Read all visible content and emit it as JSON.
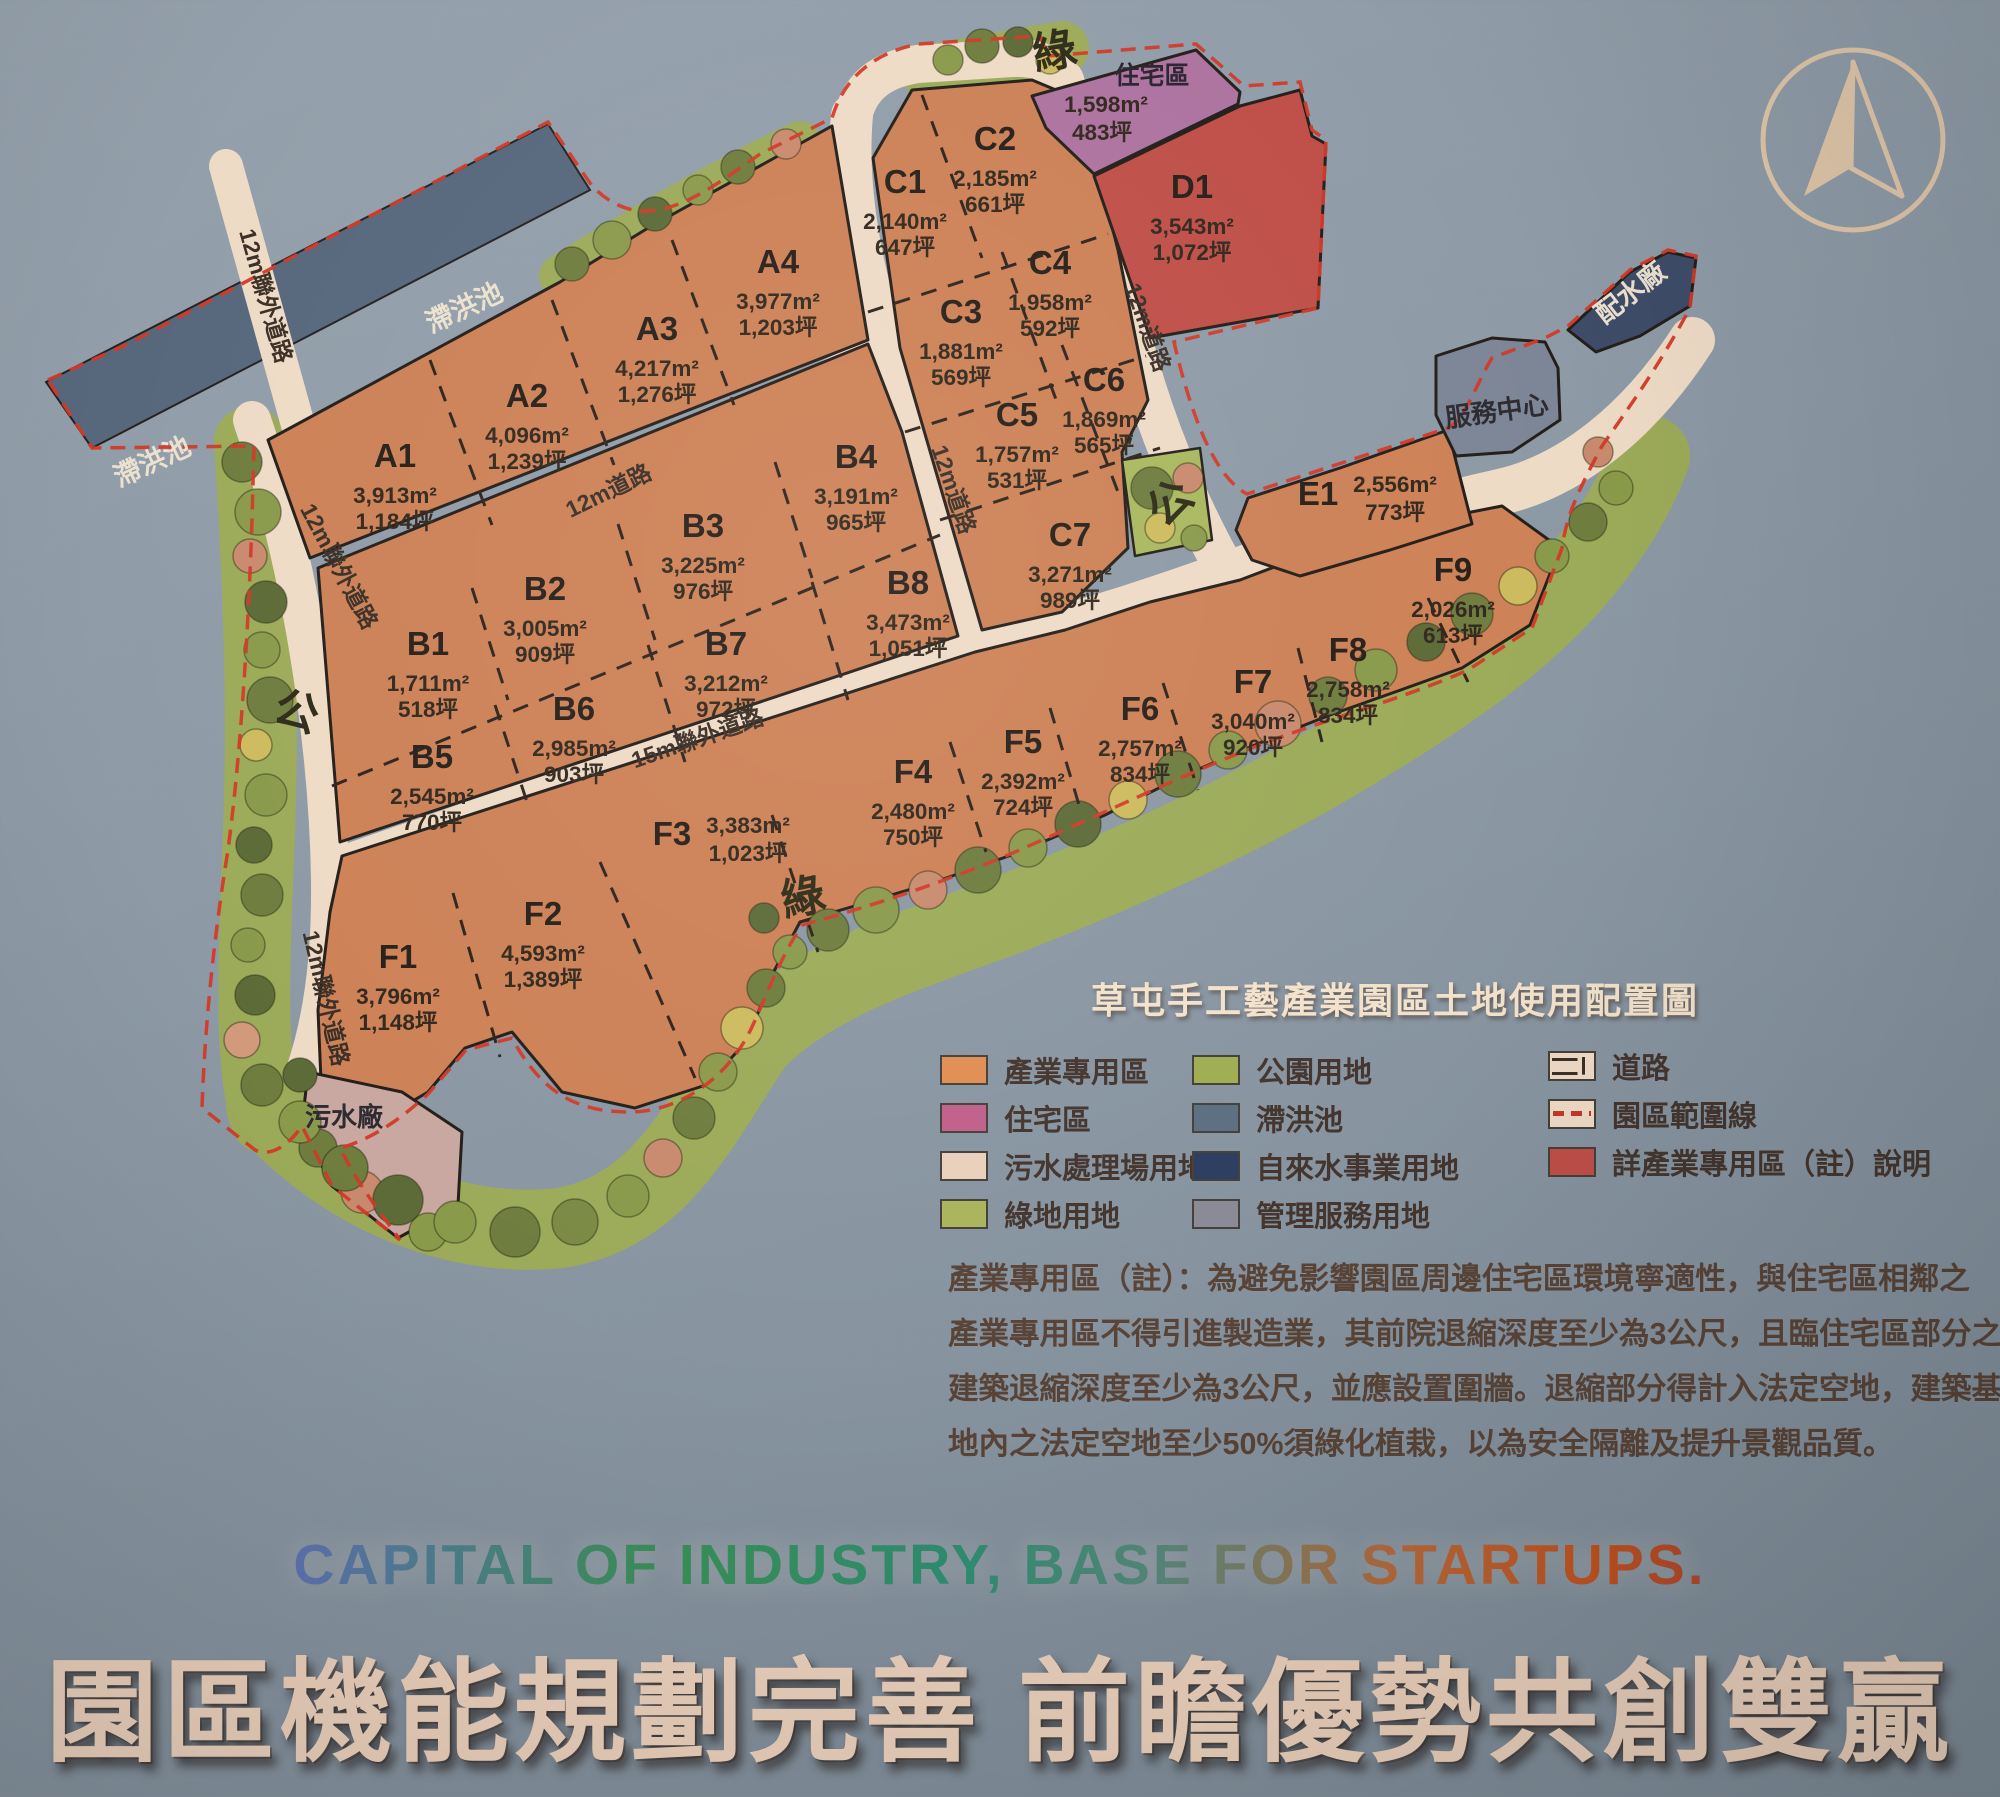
{
  "map": {
    "compass_icon": "north-arrow",
    "parcels": [
      {
        "id": "A1",
        "area_m2": "3,913m²",
        "area_ping": "1,184坪",
        "cx": 395,
        "cy": 467
      },
      {
        "id": "A2",
        "area_m2": "4,096m²",
        "area_ping": "1,239坪",
        "cx": 527,
        "cy": 407
      },
      {
        "id": "A3",
        "area_m2": "4,217m²",
        "area_ping": "1,276坪",
        "cx": 657,
        "cy": 340
      },
      {
        "id": "A4",
        "area_m2": "3,977m²",
        "area_ping": "1,203坪",
        "cx": 778,
        "cy": 273
      },
      {
        "id": "B1",
        "area_m2": "1,711m²",
        "area_ping": "518坪",
        "cx": 428,
        "cy": 655
      },
      {
        "id": "B2",
        "area_m2": "3,005m²",
        "area_ping": "909坪",
        "cx": 545,
        "cy": 600
      },
      {
        "id": "B3",
        "area_m2": "3,225m²",
        "area_ping": "976坪",
        "cx": 703,
        "cy": 537
      },
      {
        "id": "B4",
        "area_m2": "3,191m²",
        "area_ping": "965坪",
        "cx": 856,
        "cy": 468
      },
      {
        "id": "B5",
        "area_m2": "2,545m²",
        "area_ping": "770坪",
        "cx": 432,
        "cy": 768
      },
      {
        "id": "B6",
        "area_m2": "2,985m²",
        "area_ping": "903坪",
        "cx": 574,
        "cy": 720
      },
      {
        "id": "B7",
        "area_m2": "3,212m²",
        "area_ping": "972坪",
        "cx": 726,
        "cy": 655
      },
      {
        "id": "B8",
        "area_m2": "3,473m²",
        "area_ping": "1,051坪",
        "cx": 908,
        "cy": 594
      },
      {
        "id": "C1",
        "area_m2": "2,140m²",
        "area_ping": "647坪",
        "cx": 905,
        "cy": 193
      },
      {
        "id": "C2",
        "area_m2": "2,185m²",
        "area_ping": "661坪",
        "cx": 995,
        "cy": 150
      },
      {
        "id": "C3",
        "area_m2": "1,881m²",
        "area_ping": "569坪",
        "cx": 961,
        "cy": 323
      },
      {
        "id": "C4",
        "area_m2": "1,958m²",
        "area_ping": "592坪",
        "cx": 1050,
        "cy": 274
      },
      {
        "id": "C5",
        "area_m2": "1,757m²",
        "area_ping": "531坪",
        "cx": 1017,
        "cy": 426
      },
      {
        "id": "C6",
        "area_m2": "1,869m²",
        "area_ping": "565坪",
        "cx": 1104,
        "cy": 391
      },
      {
        "id": "C7",
        "area_m2": "3,271m²",
        "area_ping": "989坪",
        "cx": 1070,
        "cy": 546
      },
      {
        "id": "D1",
        "area_m2": "3,543m²",
        "area_ping": "1,072坪",
        "cx": 1192,
        "cy": 198
      },
      {
        "id": "住宅區",
        "area_m2": "1,598m²",
        "area_ping": "483坪",
        "cx": 1152,
        "cy": 84,
        "vx": 1106,
        "vy": 112,
        "small": true
      },
      {
        "id": "E1",
        "area_m2": "2,556m²",
        "area_ping": "773坪",
        "cx": 1318,
        "cy": 505,
        "vx": 1395,
        "vy": 492
      },
      {
        "id": "F1",
        "area_m2": "3,796m²",
        "area_ping": "1,148坪",
        "cx": 398,
        "cy": 968
      },
      {
        "id": "F2",
        "area_m2": "4,593m²",
        "area_ping": "1,389坪",
        "cx": 543,
        "cy": 925
      },
      {
        "id": "F3",
        "area_m2": "3,383m²",
        "area_ping": "1,023坪",
        "cx": 672,
        "cy": 845,
        "vx": 748,
        "vy": 833
      },
      {
        "id": "F4",
        "area_m2": "2,480m²",
        "area_ping": "750坪",
        "cx": 913,
        "cy": 783
      },
      {
        "id": "F5",
        "area_m2": "2,392m²",
        "area_ping": "724坪",
        "cx": 1023,
        "cy": 753
      },
      {
        "id": "F6",
        "area_m2": "2,757m²",
        "area_ping": "834坪",
        "cx": 1140,
        "cy": 720
      },
      {
        "id": "F7",
        "area_m2": "3,040m²",
        "area_ping": "920坪",
        "cx": 1253,
        "cy": 693
      },
      {
        "id": "F8",
        "area_m2": "2,758m²",
        "area_ping": "834坪",
        "cx": 1348,
        "cy": 661
      },
      {
        "id": "F9",
        "area_m2": "2,026m²",
        "area_ping": "613坪",
        "cx": 1453,
        "cy": 581
      }
    ],
    "road_labels": [
      {
        "text": "12m聯外道路",
        "x": 258,
        "y": 298,
        "rot": 74
      },
      {
        "text": "12m聯外道路",
        "x": 332,
        "y": 570,
        "rot": 62
      },
      {
        "text": "12m聯外道路",
        "x": 318,
        "y": 1000,
        "rot": 77
      },
      {
        "text": "12m道路",
        "x": 612,
        "y": 498,
        "rot": -26
      },
      {
        "text": "12m道路",
        "x": 946,
        "y": 492,
        "rot": 71
      },
      {
        "text": "12m道路",
        "x": 1140,
        "y": 330,
        "rot": 70
      },
      {
        "text": "15m聯外道路",
        "x": 700,
        "y": 746,
        "rot": -19
      }
    ],
    "area_labels": [
      {
        "text": "滯洪池",
        "x": 468,
        "y": 316,
        "rot": -25,
        "style": "light"
      },
      {
        "text": "滯洪池",
        "x": 156,
        "y": 470,
        "rot": -25,
        "style": "light"
      },
      {
        "text": "配水廠",
        "x": 1636,
        "y": 300,
        "rot": -38,
        "style": "light"
      },
      {
        "text": "服務中心",
        "x": 1498,
        "y": 420,
        "rot": -8,
        "style": "dark"
      },
      {
        "text": "污水廠",
        "x": 344,
        "y": 1126,
        "rot": 0,
        "style": "dark"
      },
      {
        "text": "公",
        "x": 292,
        "y": 726,
        "rot": 18,
        "style": "big"
      },
      {
        "text": "公",
        "x": 1180,
        "y": 514,
        "rot": -42,
        "style": "big"
      },
      {
        "text": "綠",
        "x": 1057,
        "y": 66,
        "rot": -10,
        "style": "big"
      },
      {
        "text": "綠",
        "x": 806,
        "y": 912,
        "rot": -12,
        "style": "big"
      }
    ]
  },
  "legend": {
    "title": "草屯手工藝產業園區土地使用配置圖",
    "columns": [
      [
        {
          "label": "產業專用區",
          "type": "solid",
          "color": "#e08d52"
        },
        {
          "label": "住宅區",
          "type": "solid",
          "color": "#c0608a"
        },
        {
          "label": "污水處理場用地",
          "type": "solid",
          "color": "#ead0bd"
        },
        {
          "label": "綠地用地",
          "type": "solid",
          "color": "#a9b45b"
        }
      ],
      [
        {
          "label": "公園用地",
          "type": "solid",
          "color": "#9fae51"
        },
        {
          "label": "滯洪池",
          "type": "solid",
          "color": "#5d6f81"
        },
        {
          "label": "自來水事業用地",
          "type": "solid",
          "color": "#2d3e60"
        },
        {
          "label": "管理服務用地",
          "type": "solid",
          "color": "#8b8b97"
        }
      ],
      [
        {
          "label": "道路",
          "type": "road",
          "color": "#eedbc6"
        },
        {
          "label": "園區範圍線",
          "type": "dashed",
          "color": "#c5372a"
        },
        {
          "label": "詳產業專用區（註）說明",
          "type": "solid",
          "color": "#bf4f48"
        }
      ]
    ]
  },
  "note": {
    "lines": [
      "產業專用區（註）：為避免影響園區周邊住宅區環境寧適性，與住宅區相鄰之",
      "產業專用區不得引進製造業，其前院退縮深度至少為3公尺，且臨住宅區部分之",
      "建築退縮深度至少為3公尺，並應設置圍牆。退縮部分得計入法定空地，建築基",
      "地內之法定空地至少50%須綠化植栽，以為安全隔離及提升景觀品質。"
    ]
  },
  "footer": {
    "tagline_en": "CAPITAL OF INDUSTRY, BASE FOR STARTUPS.",
    "title_zh": "園區機能規劃完善 前瞻優勢共創雙贏"
  },
  "colors": {
    "background": "#8c99a5",
    "parcel_orange": "#cd8156",
    "road_cream": "#eedbc6",
    "residential_purple": "#ad73a0",
    "special_red": "#bf4f48",
    "detention_slate": "#57687d",
    "waterworks_navy": "#3e4c68",
    "management_gray": "#7d8697",
    "sewage_pink": "#c8a8a0",
    "green_olive": "#9cab59",
    "boundary_red": "#d23a28"
  }
}
